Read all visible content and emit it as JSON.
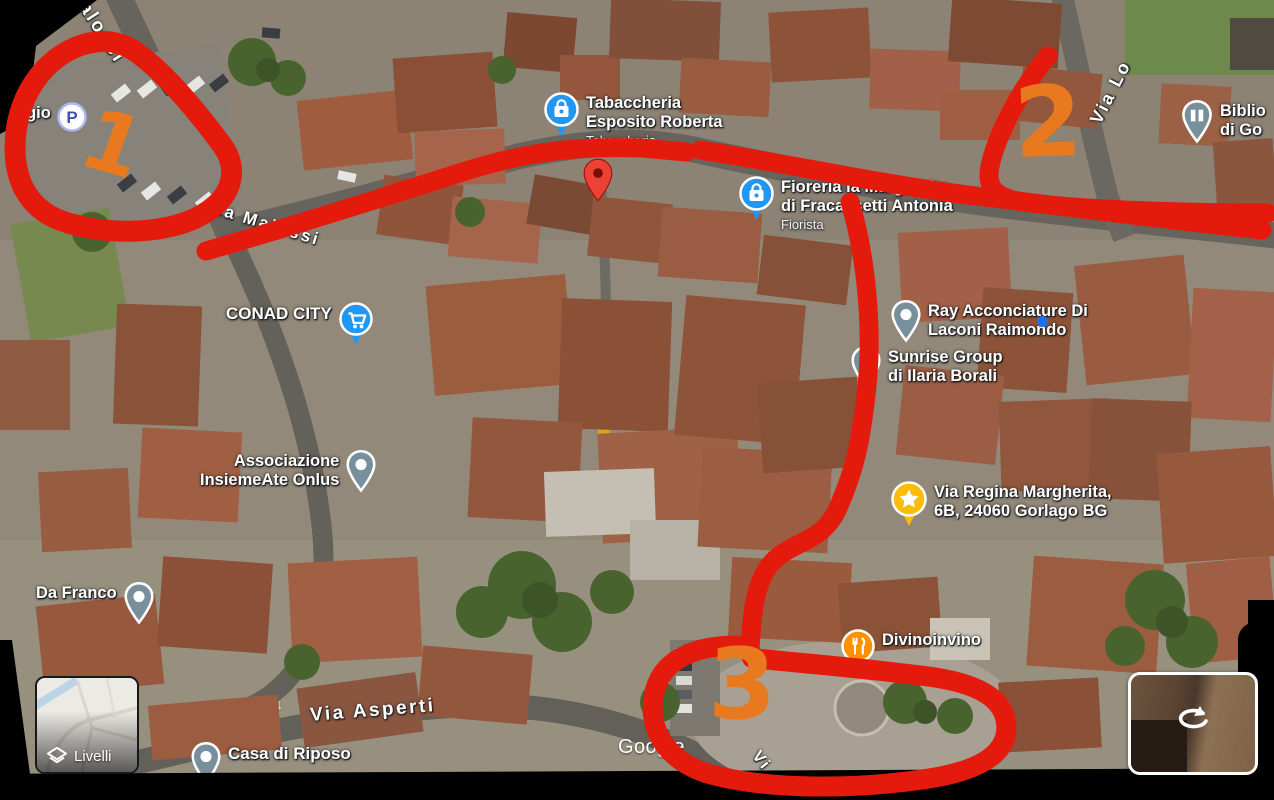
{
  "watermark": "Google",
  "controls": {
    "layers_label": "Livelli"
  },
  "annotations": {
    "region1": "1",
    "region2": "2",
    "region3": "3"
  },
  "colors": {
    "annotation_red": "#e41b0c",
    "annotation_orange": "#e8791f",
    "poi_blue": "#2196f3",
    "poi_gray": "#78909c",
    "poi_amber": "#fbbc04",
    "poi_orange": "#ff9100",
    "pin_red": "#ea4335"
  },
  "places": {
    "parking_partial": {
      "label": "ggio",
      "icon_letter": "P"
    },
    "tabaccheria": {
      "line1": "Tabaccheria",
      "line2": "Esposito Roberta",
      "category": "Tabaccheria"
    },
    "fioreria": {
      "line1": "Fioreria la Margherita",
      "line2": "di Fracassetti Antonia",
      "category": "Fiorista"
    },
    "conad": {
      "line1": "CONAD CITY"
    },
    "ray": {
      "line1": "Ray Acconciature Di",
      "line2": "Laconi Raimondo"
    },
    "sunrise": {
      "line1": "Sunrise Group",
      "line2": "di Ilaria Borali"
    },
    "saved_address": {
      "line1": "Via Regina Margherita,",
      "line2": "6B, 24060 Gorlago BG"
    },
    "divinoinvino": {
      "line1": "Divinoinvino"
    },
    "associazione": {
      "line1": "Associazione",
      "line2": "InsiemeAte Onlus"
    },
    "da_franco": {
      "line1": "Da Franco"
    },
    "casa_di_riposo": {
      "line1": "Casa di Riposo"
    },
    "biblioteca": {
      "line1": "Biblio",
      "line2": "di Go"
    }
  },
  "streets": {
    "malossi_top": "alossi",
    "malossi_mid": "Via Malossi",
    "via_lo": "Via Lo",
    "asperti": "Via Asperti",
    "vi_partial": "Vi"
  }
}
